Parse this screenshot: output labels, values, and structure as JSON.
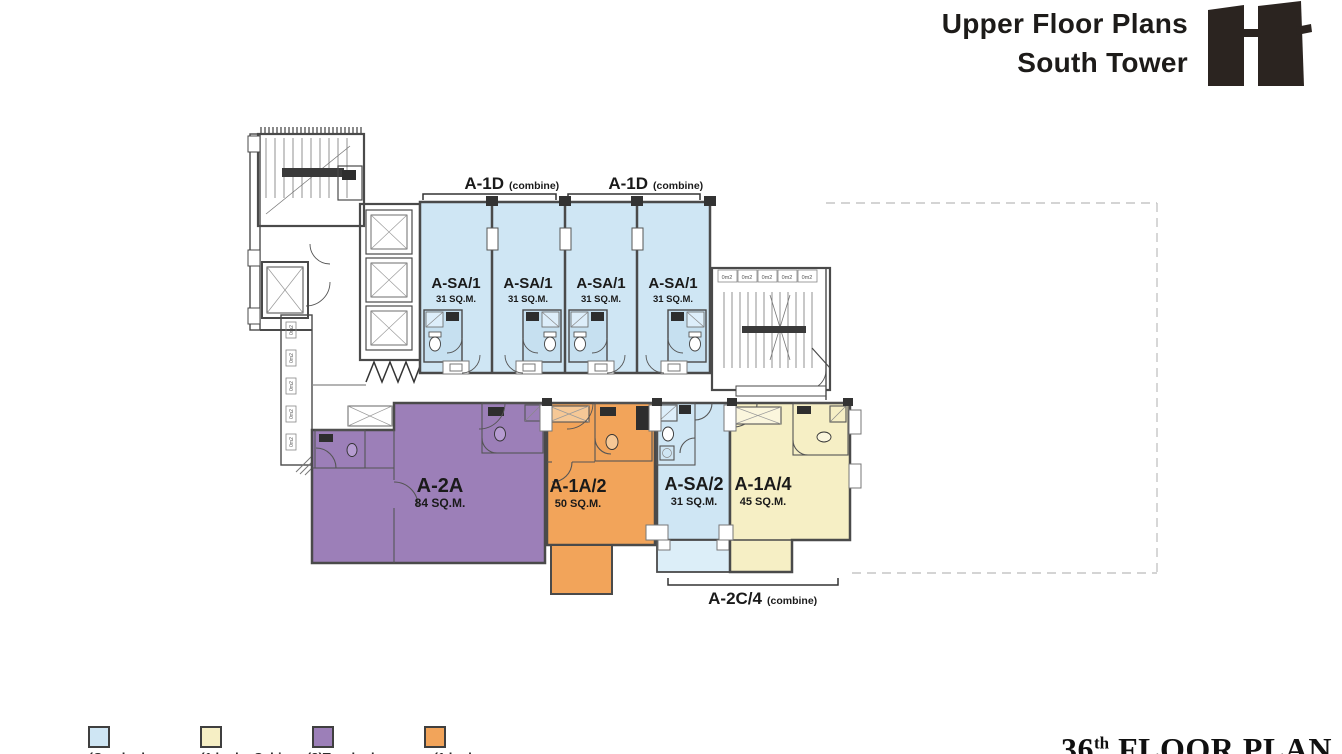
{
  "header": {
    "title_line1": "Upper Floor Plans",
    "title_line2": "South Tower",
    "logo": "two-tower-building-mark"
  },
  "floor_label": {
    "number": "36",
    "ordinal": "th",
    "text": "FLOOR PLAN"
  },
  "plan": {
    "brackets": [
      {
        "label": "A-1D",
        "note": "(combine)"
      },
      {
        "label": "A-1D",
        "note": "(combine)"
      },
      {
        "label": "A-2C/4",
        "note": "(combine)"
      }
    ],
    "units": [
      {
        "name": "A-SA/1",
        "area": "31 SQ.M.",
        "type_color": "#cfe6f4"
      },
      {
        "name": "A-SA/1",
        "area": "31 SQ.M.",
        "type_color": "#cfe6f4"
      },
      {
        "name": "A-SA/1",
        "area": "31 SQ.M.",
        "type_color": "#cfe6f4"
      },
      {
        "name": "A-SA/1",
        "area": "31 SQ.M.",
        "type_color": "#cfe6f4"
      },
      {
        "name": "A-2A",
        "area": "84 SQ.M.",
        "type_color": "#9c7fb8"
      },
      {
        "name": "A-1A/2",
        "area": "50 SQ.M.",
        "type_color": "#f2a45a"
      },
      {
        "name": "A-SA/2",
        "area": "31 SQ.M.",
        "type_color": "#cfe6f4"
      },
      {
        "name": "A-1A/4",
        "area": "45 SQ.M.",
        "type_color": "#f6efc5"
      }
    ],
    "core": {
      "stair_tags": [
        "0m2",
        "0m2",
        "0m2",
        "0m2",
        "0m2"
      ],
      "corridor_tags": [
        "0m2",
        "0m2",
        "0m2",
        "0m2",
        "0m2"
      ]
    }
  },
  "legend": {
    "items": [
      {
        "color": "#cfe6f4",
        "label": "(One bedroom"
      },
      {
        "color": "#f6efc5",
        "label": "(1 bed + Cabin"
      },
      {
        "color": "#9c7fb8",
        "label": "(2)Two bedroom"
      },
      {
        "color": "#f2a45a",
        "label": "(1 bedroom"
      }
    ]
  },
  "colors": {
    "wall": "#4a4a4a",
    "studio_blue": "#cfe6f4",
    "one_bed_cream": "#f6efc5",
    "two_bed_purple": "#9c7fb8",
    "one_bed_orange": "#f2a45a",
    "dashed_outline": "#c6c6c6",
    "title_text": "#1d1b19",
    "logo_dark": "#2b2420"
  }
}
